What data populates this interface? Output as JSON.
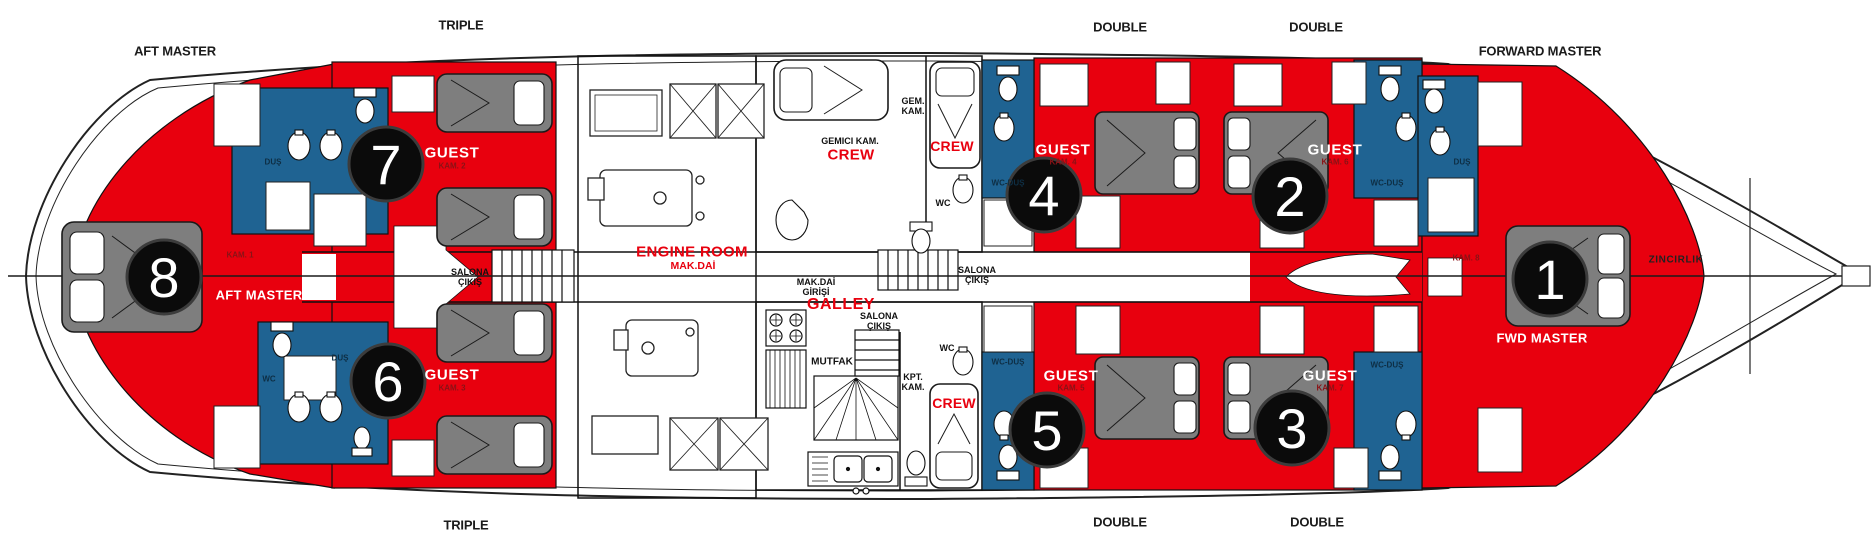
{
  "title": "Gulet lower deck cabin plan",
  "colors": {
    "cabin_red": "#E8000E",
    "bath_blue": "#1F6392",
    "bed_grey": "#7E7E7E",
    "number_circle": "#0B0B0B",
    "hull_line": "#222222"
  },
  "deck_labels": {
    "top": [
      "AFT MASTER",
      "TRIPLE",
      "DOUBLE",
      "DOUBLE",
      "FORWARD MASTER"
    ],
    "bottom": [
      "TRIPLE",
      "DOUBLE",
      "DOUBLE"
    ]
  },
  "cabins": [
    {
      "number": "1",
      "label": "FWD MASTER",
      "kam": "KAM. 8",
      "type": "FORWARD MASTER"
    },
    {
      "number": "2",
      "label": "GUEST",
      "kam": "KAM. 6",
      "type": "DOUBLE"
    },
    {
      "number": "3",
      "label": "GUEST",
      "kam": "KAM. 7",
      "type": "DOUBLE"
    },
    {
      "number": "4",
      "label": "GUEST",
      "kam": "KAM. 4",
      "type": "DOUBLE"
    },
    {
      "number": "5",
      "label": "GUEST",
      "kam": "KAM. 5",
      "type": "DOUBLE"
    },
    {
      "number": "6",
      "label": "GUEST",
      "kam": "KAM. 3",
      "type": "TRIPLE"
    },
    {
      "number": "7",
      "label": "GUEST",
      "kam": "KAM. 2",
      "type": "TRIPLE"
    },
    {
      "number": "8",
      "label": "AFT MASTER",
      "kam": "KAM. 1",
      "type": "AFT MASTER"
    }
  ],
  "rooms": {
    "engine_room": "ENGINE ROOM",
    "engine_room_tr": "MAK.DAİ",
    "engine_entry": "MAK.DAİ\nGİRİŞİ",
    "galley": "GALLEY",
    "galley_tr": "MUTFAK",
    "crew": "CREW",
    "crew_cabin_tr": "GEMICI KAM.",
    "crew_cabin2_tr": "GEM.\nKAM.",
    "captain_tr": "KPT.\nKAM.",
    "salon_exit": "SALONA\nÇIKIŞ",
    "wc": "WC",
    "wc_shower": "WC-DUŞ",
    "shower": "DUŞ",
    "chain_locker": "ZINCIRLIK"
  }
}
